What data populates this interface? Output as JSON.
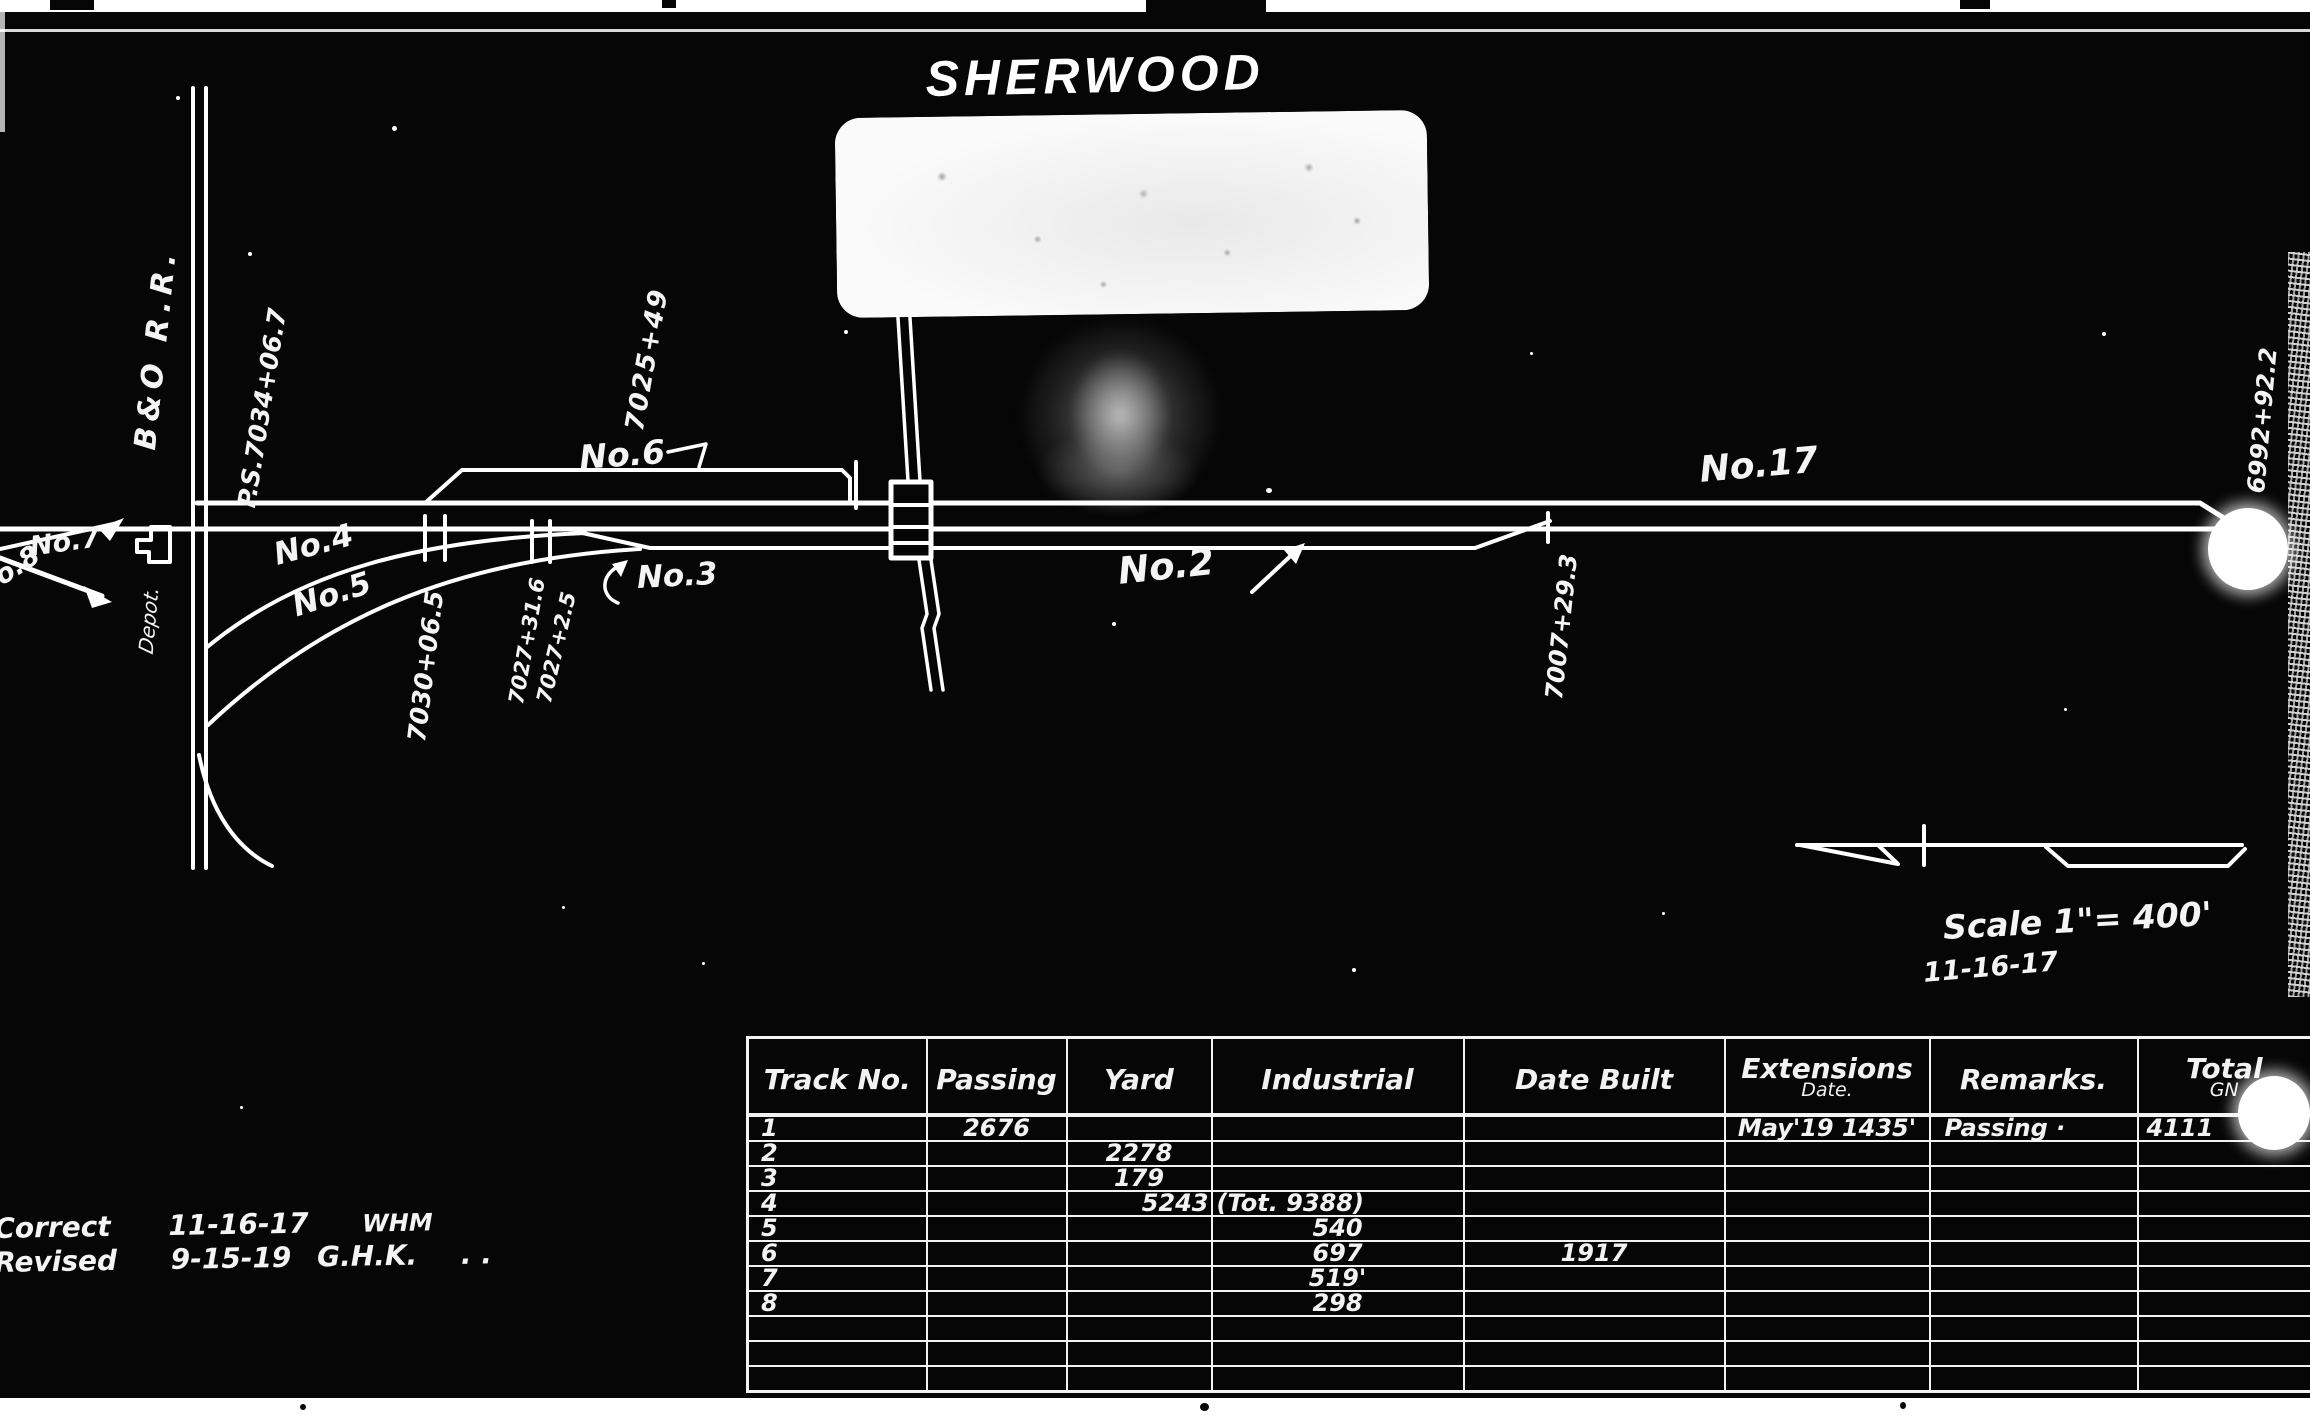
{
  "page": {
    "title": "SHERWOOD"
  },
  "colors": {
    "background": "#060606",
    "ink": "#ffffff"
  },
  "diagram": {
    "railroad_label": "B&O R.R.",
    "depot_label": "Depot.",
    "tracks": {
      "no2": "No.2",
      "no3": "No.3",
      "no4": "No.4",
      "no5": "No.5",
      "no6": "No.6",
      "no7": "No.7",
      "no8": "No.8",
      "no17": "No.17"
    },
    "stations": {
      "ps_7034": "P.S.7034+06.7",
      "s7025": "7025+49",
      "s7030": "7030+06.5",
      "s7027a": "7027+31.6",
      "s7027b": "7027+2.5",
      "s7007": "7007+29.3",
      "s6992": "6992+92.2"
    },
    "scale_note": {
      "scale": "Scale 1\"= 400'",
      "date": "11-16-17"
    }
  },
  "notes": {
    "correct": {
      "label": "Correct",
      "date": "11-16-17",
      "initials": "WHM"
    },
    "revised": {
      "label": "Revised",
      "date": "9-15-19",
      "initials": "G.H.K.",
      "suffix": ". ."
    }
  },
  "table": {
    "headers": [
      {
        "label": "Track No."
      },
      {
        "label": "Passing"
      },
      {
        "label": "Yard"
      },
      {
        "label": "Industrial"
      },
      {
        "label": "Date Built"
      },
      {
        "label": "Extensions",
        "sub": "Date."
      },
      {
        "label": "Remarks."
      },
      {
        "label": "Total",
        "sub": "GN"
      }
    ],
    "rows": [
      {
        "track": "1",
        "passing": "2676",
        "yard": "",
        "industrial": "",
        "date_built": "",
        "extensions": "May'19 1435'",
        "remarks": "Passing ·",
        "total": "4111"
      },
      {
        "track": "2",
        "passing": "",
        "yard": "2278",
        "industrial": "",
        "date_built": "",
        "extensions": "",
        "remarks": "",
        "total": ""
      },
      {
        "track": "3",
        "passing": "",
        "yard": "179",
        "industrial": "",
        "date_built": "",
        "extensions": "",
        "remarks": "",
        "total": ""
      },
      {
        "track": "4",
        "passing": "",
        "yard": "5243",
        "industrial": "(Tot. 9388)",
        "date_built": "",
        "extensions": "",
        "remarks": "",
        "total": ""
      },
      {
        "track": "5",
        "passing": "",
        "yard": "",
        "industrial": "540",
        "date_built": "",
        "extensions": "",
        "remarks": "",
        "total": ""
      },
      {
        "track": "6",
        "passing": "",
        "yard": "",
        "industrial": "697",
        "date_built": "1917",
        "extensions": "",
        "remarks": "",
        "total": ""
      },
      {
        "track": "7",
        "passing": "",
        "yard": "",
        "industrial": "519'",
        "date_built": "",
        "extensions": "",
        "remarks": "",
        "total": ""
      },
      {
        "track": "8",
        "passing": "",
        "yard": "",
        "industrial": "298",
        "date_built": "",
        "extensions": "",
        "remarks": "",
        "total": ""
      },
      {
        "track": "",
        "passing": "",
        "yard": "",
        "industrial": "",
        "date_built": "",
        "extensions": "",
        "remarks": "",
        "total": ""
      },
      {
        "track": "",
        "passing": "",
        "yard": "",
        "industrial": "",
        "date_built": "",
        "extensions": "",
        "remarks": "",
        "total": ""
      },
      {
        "track": "",
        "passing": "",
        "yard": "",
        "industrial": "",
        "date_built": "",
        "extensions": "",
        "remarks": "",
        "total": ""
      }
    ]
  }
}
